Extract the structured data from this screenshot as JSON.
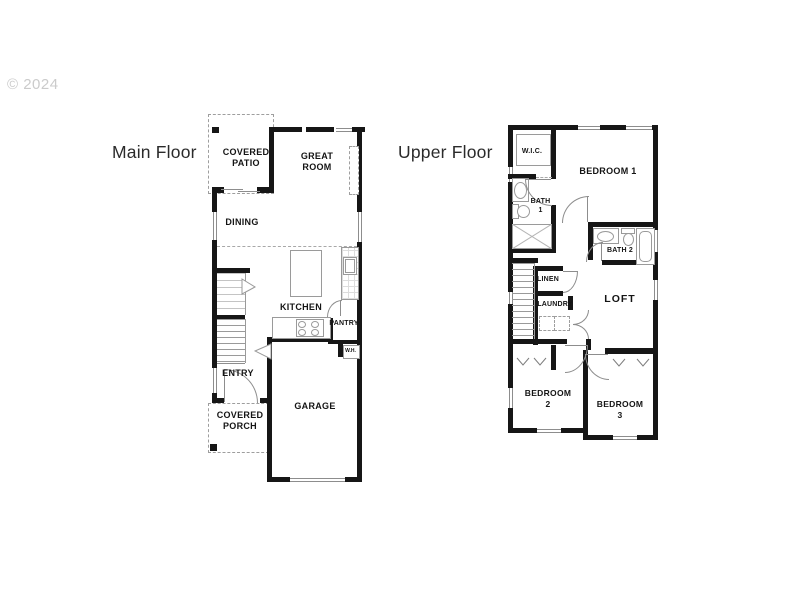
{
  "watermark": "© 2024",
  "colors": {
    "background": "#ffffff",
    "wall": "#161616",
    "thin_line": "#8d8d8d",
    "dashed_line": "#9e9e9e",
    "label_text": "#141414",
    "title_text": "#2b2b2b",
    "watermark_text": "#cbcbcb"
  },
  "main_floor": {
    "title": "Main Floor",
    "rooms": {
      "covered_patio": "COVERED PATIO",
      "great_room": "GREAT ROOM",
      "dining": "DINING",
      "kitchen": "KITCHEN",
      "pantry": "PANTRY",
      "water_heater": "W.H.",
      "entry": "ENTRY",
      "covered_porch": "COVERED PORCH",
      "garage": "GARAGE"
    }
  },
  "upper_floor": {
    "title": "Upper Floor",
    "rooms": {
      "walk_in_closet": "W.I.C.",
      "bedroom_1": "BEDROOM 1",
      "bath_1": "BATH 1",
      "bath_2": "BATH 2",
      "linen": "LINEN",
      "laundry": "LAUNDRY",
      "loft": "LOFT",
      "bedroom_2": "BEDROOM 2",
      "bedroom_3": "BEDROOM 3"
    }
  }
}
